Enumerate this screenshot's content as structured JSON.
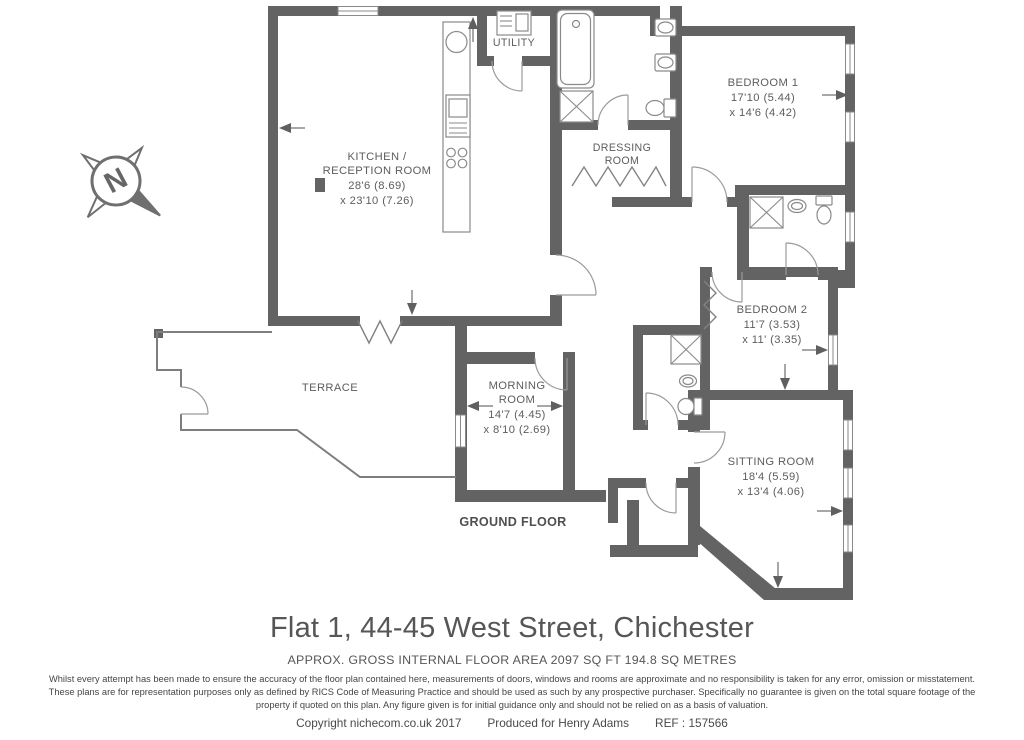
{
  "plan": {
    "compass": {
      "letter": "N"
    },
    "rooms": {
      "kitchen": {
        "name1": "KITCHEN /",
        "name2": "RECEPTION ROOM",
        "dim1": "28'6 (8.69)",
        "dim2": "x 23'10 (7.26)"
      },
      "utility": {
        "name": "UTILITY"
      },
      "dressing": {
        "name1": "DRESSING",
        "name2": "ROOM"
      },
      "bedroom1": {
        "name": "BEDROOM 1",
        "dim1": "17'10 (5.44)",
        "dim2": "x 14'6 (4.42)"
      },
      "bedroom2": {
        "name": "BEDROOM 2",
        "dim1": "11'7 (3.53)",
        "dim2": "x 11' (3.35)"
      },
      "morning": {
        "name1": "MORNING",
        "name2": "ROOM",
        "dim1": "14'7 (4.45)",
        "dim2": "x 8'10 (2.69)"
      },
      "sitting": {
        "name": "SITTING ROOM",
        "dim1": "18'4 (5.59)",
        "dim2": "x 13'4 (4.06)"
      },
      "terrace": {
        "name": "TERRACE"
      }
    },
    "floor_label": "GROUND FLOOR"
  },
  "footer": {
    "title": "Flat 1, 44-45 West Street, Chichester",
    "area_line": "APPROX. GROSS INTERNAL FLOOR AREA 2097 SQ FT 194.8 SQ METRES",
    "disclaimer1": "Whilst every attempt has been made to ensure the accuracy of the floor plan contained here, measurements of doors, windows and rooms are approximate and no responsibility is taken for any error, omission or misstatement.",
    "disclaimer2": "These plans are for representation purposes only as defined by RICS Code of Measuring Practice and should be used as such by any prospective purchaser.  Specifically no guarantee is given on the total square footage of the",
    "disclaimer3": "property if quoted on this plan. Any figure given is for initial guidance only and should not be relied on as a basis of valuation.",
    "copyright": "Copyright nichecom.co.uk 2017",
    "produced": "Produced for Henry Adams",
    "ref": "REF : 157566"
  },
  "colors": {
    "wall": "#636363",
    "thin_line": "#7e7e7e",
    "label_text": "#5d5d5d",
    "title_text": "#565656"
  }
}
